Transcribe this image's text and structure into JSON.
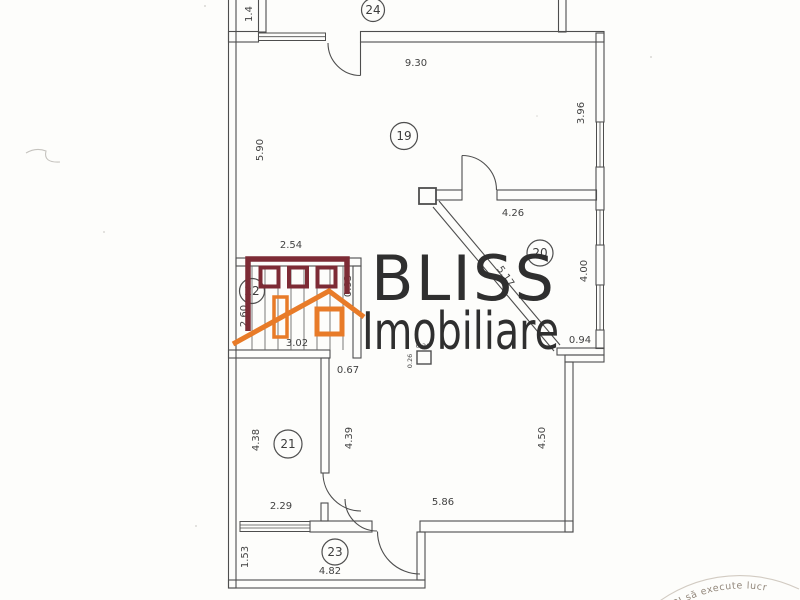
{
  "floorplan": {
    "room_numbers": {
      "r24": "24",
      "r19": "19",
      "r20": "20",
      "r22": "22",
      "r21": "21",
      "r23": "23"
    },
    "dimensions": {
      "shaft_width": "1.4",
      "room19_width": "9.30",
      "room19_left_height": "5.90",
      "room19_right_height": "3.96",
      "room20_top_width": "4.26",
      "diagonal_wall": "5.17",
      "room20_right_height": "4.00",
      "step_width": "0.94",
      "stair_top_width": "2.54",
      "stair_left_height": "2.60",
      "stair_right_height": "0.93",
      "stair_width": "3.02",
      "opening_width": "0.67",
      "pillar_width": "0.26",
      "pillar_height": "0.26",
      "room21_left_height": "4.38",
      "hall_left_height": "4.39",
      "room21_bottom_width": "2.29",
      "hall_right_height": "4.50",
      "hall_bottom_width": "5.86",
      "room23_left_height": "1.53",
      "room23_bottom_width": "4.82"
    }
  },
  "watermark": {
    "line1": "BLISS",
    "line2": "Imobiliare"
  },
  "logo_colors": {
    "maroon": "#7d2b35",
    "orange": "#e87b28"
  },
  "stamp": {
    "arc_text": "ANCPI să execute lucr"
  }
}
